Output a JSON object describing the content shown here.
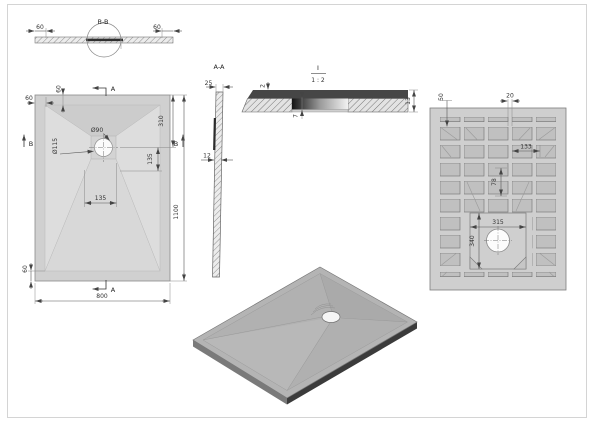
{
  "drawing": {
    "section_bb": {
      "title": "B-B",
      "dim_left": "60",
      "dim_right": "60"
    },
    "top_view": {
      "dim_border_left": "60",
      "dim_border_top": "60",
      "dim_drain_dia": "Ø90",
      "dim_recess_dia": "Ø115",
      "dim_310": "310",
      "dim_135_right": "135",
      "dim_135_bottom": "135",
      "dim_1100": "1100",
      "dim_border_bottom": "60",
      "dim_800": "800",
      "label_a_top": "A",
      "label_a_bottom": "A",
      "label_b_left": "B",
      "label_b_right": "B"
    },
    "section_aa": {
      "title": "A-A",
      "dim_top": "25",
      "dim_mid": "12"
    },
    "detail_i": {
      "title": "I",
      "scale": "1 : 2",
      "dim_lip": "2",
      "dim_depth": "7",
      "dim_thickness": "13"
    },
    "bottom_view": {
      "dim_50": "50",
      "dim_20": "20",
      "dim_133": "133",
      "dim_78": "78",
      "dim_315": "315",
      "dim_340": "340"
    }
  },
  "colors": {
    "tray_gray": "#d0d0d0",
    "rib_gray": "#c0c0c0",
    "iso_top": "#b4b4b4",
    "dark_edge": "#3b3b3b",
    "line": "#555555"
  }
}
